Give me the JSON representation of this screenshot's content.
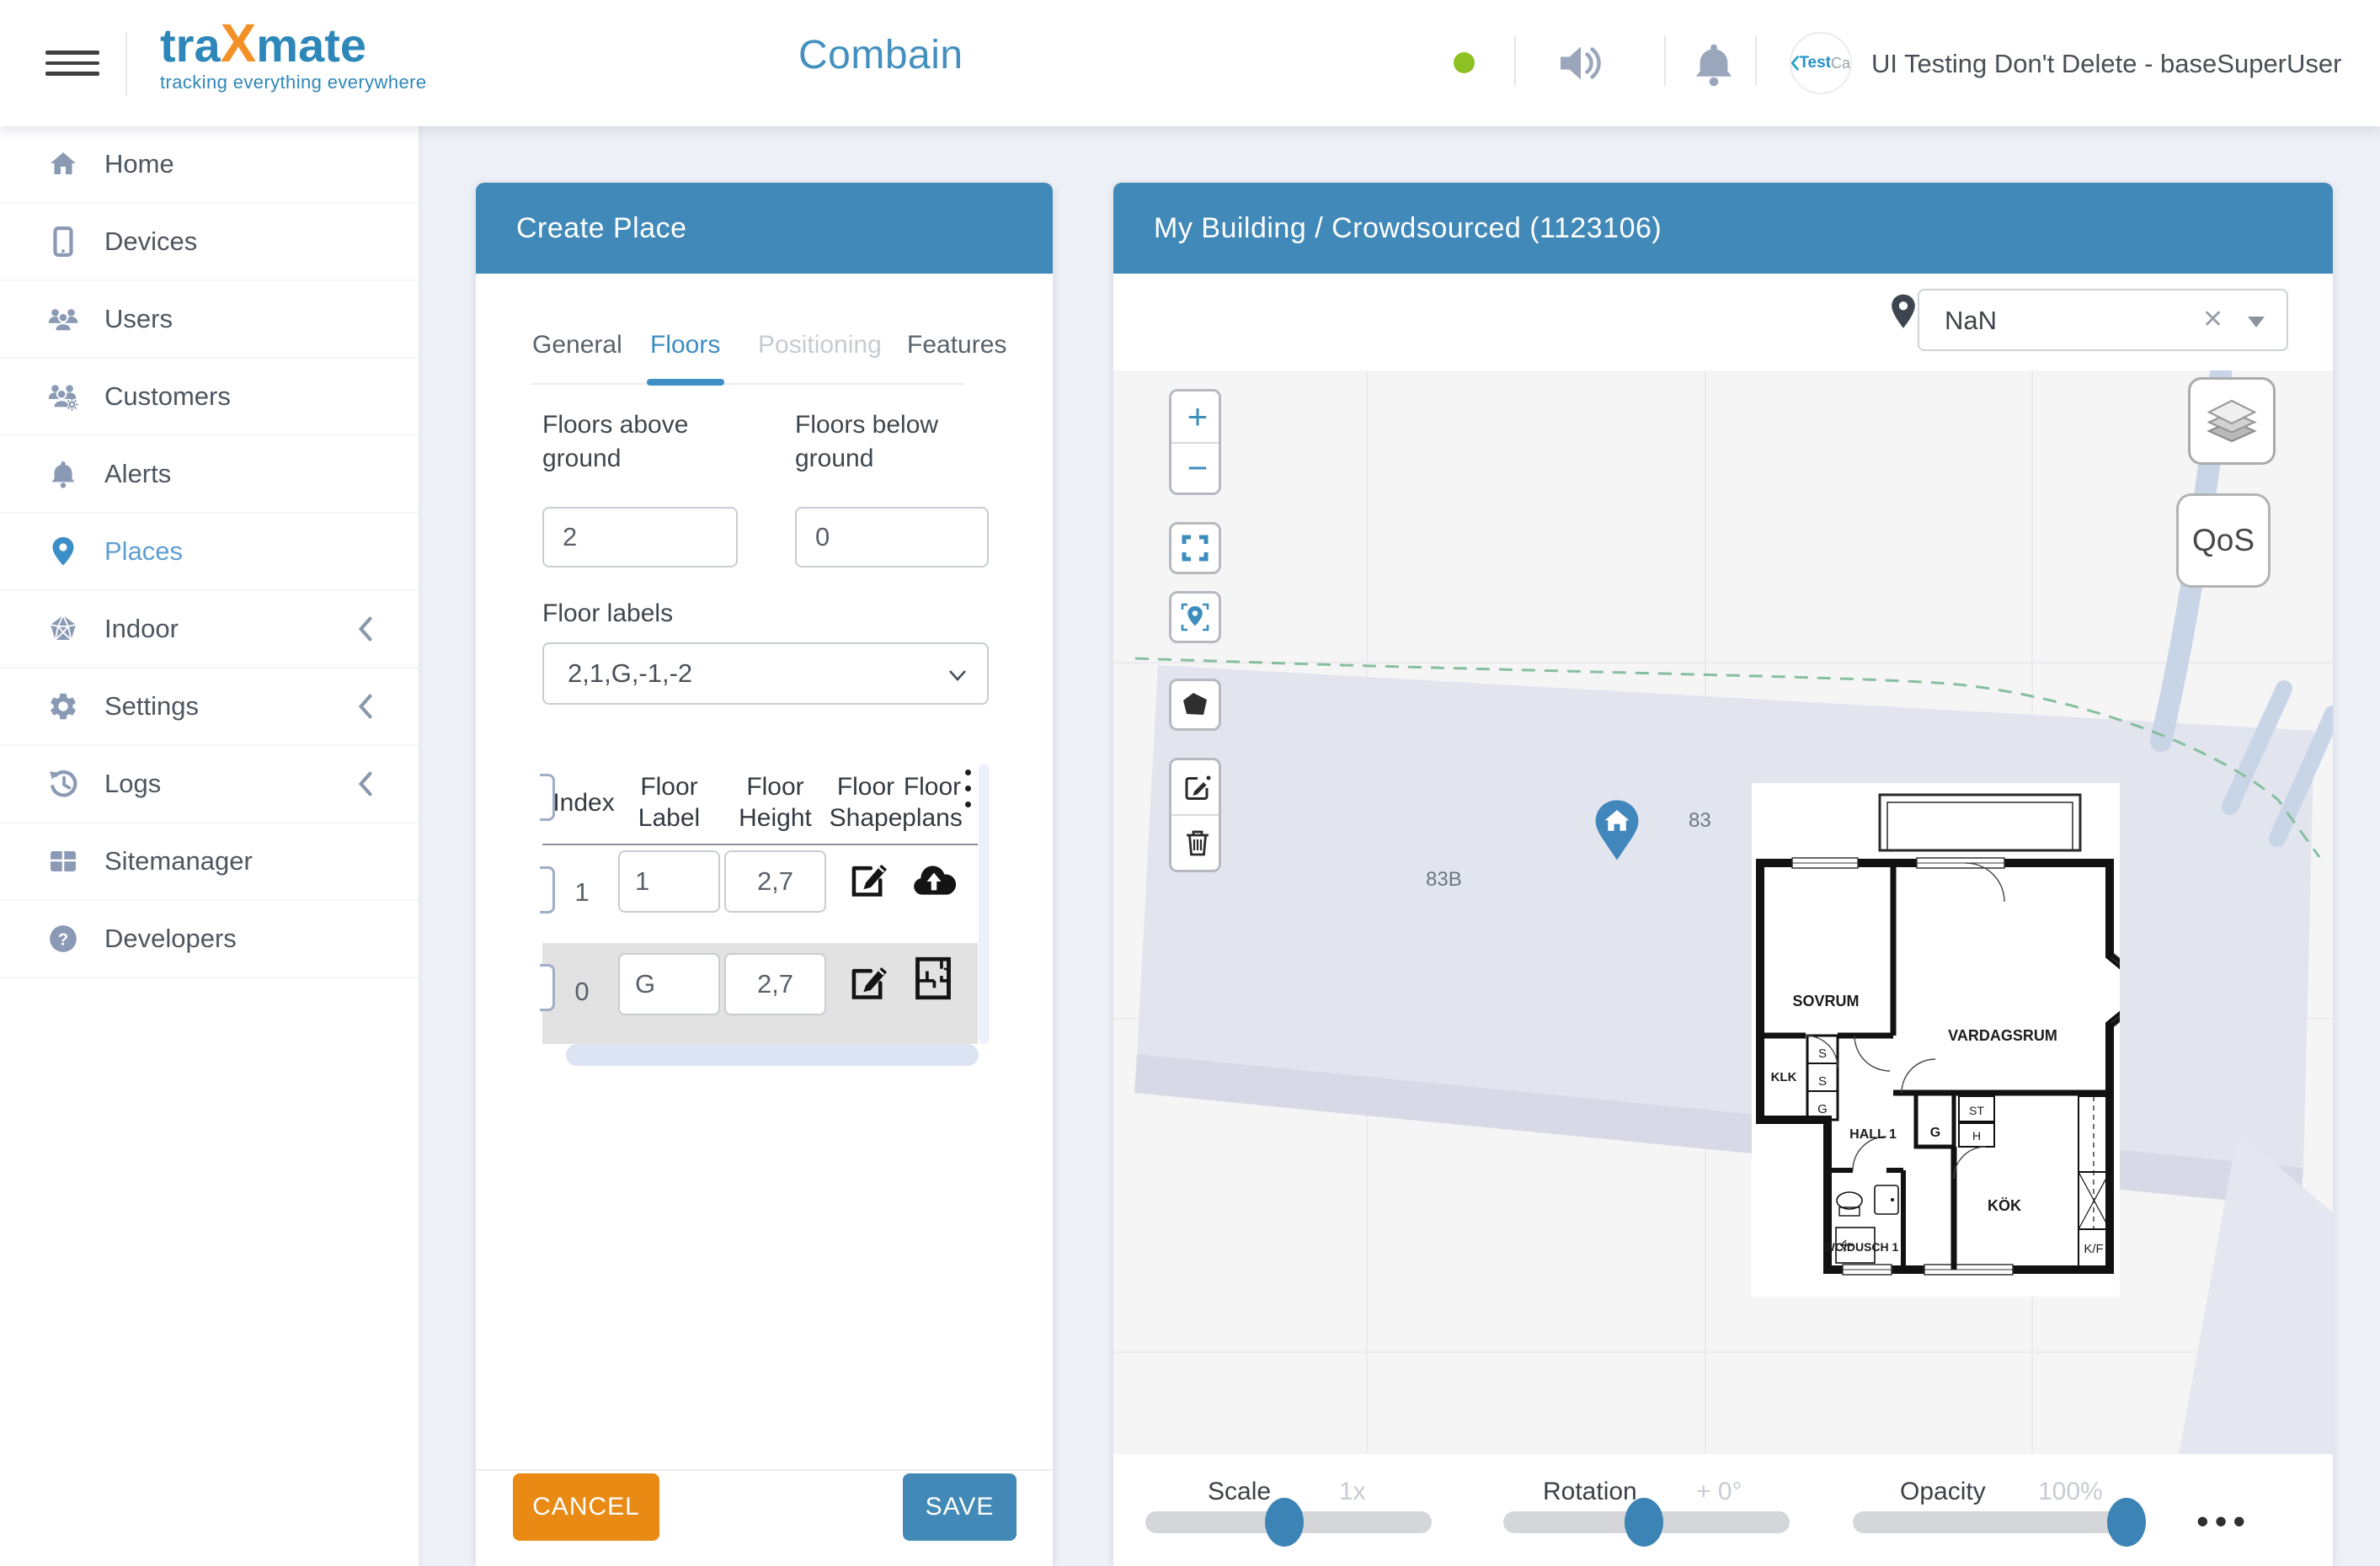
{
  "navbar": {
    "logo": {
      "part1": "tra",
      "part2": "X",
      "part3": "mate",
      "tagline": "tracking everything everywhere"
    },
    "title": "Combain",
    "user": {
      "avatar_text1": "Test",
      "avatar_text2": "Ca",
      "name": "UI Testing Don't Delete - baseSuperUser"
    }
  },
  "sidebar": {
    "items": [
      {
        "label": "Home"
      },
      {
        "label": "Devices"
      },
      {
        "label": "Users"
      },
      {
        "label": "Customers"
      },
      {
        "label": "Alerts"
      },
      {
        "label": "Places"
      },
      {
        "label": "Indoor"
      },
      {
        "label": "Settings"
      },
      {
        "label": "Logs"
      },
      {
        "label": "Sitemanager"
      },
      {
        "label": "Developers"
      }
    ]
  },
  "create_place": {
    "title": "Create Place",
    "tabs": [
      {
        "label": "General",
        "state": "default"
      },
      {
        "label": "Floors",
        "state": "active"
      },
      {
        "label": "Positioning",
        "state": "disabled"
      },
      {
        "label": "Features",
        "state": "default"
      }
    ],
    "form": {
      "floors_above": {
        "label": "Floors above ground",
        "value": "2"
      },
      "floors_below": {
        "label": "Floors below ground",
        "value": "0"
      },
      "floor_labels": {
        "label": "Floor labels",
        "value": "2,1,G,-1,-2"
      }
    },
    "table": {
      "columns": [
        "Index",
        "Floor Label",
        "Floor Height",
        "Floor Shape",
        "Floor plans"
      ],
      "rows": [
        {
          "index": "1",
          "floor_label": "1",
          "floor_height": "2,7"
        },
        {
          "index": "0",
          "floor_label": "G",
          "floor_height": "2,7"
        }
      ]
    },
    "actions": {
      "cancel": "CANCEL",
      "save": "SAVE"
    }
  },
  "map_panel": {
    "title": "My Building / Crowdsourced (1123106)",
    "floor_selector": {
      "value": "NaN",
      "clear": "✕"
    },
    "qos_label": "QoS",
    "address_labels": {
      "a": "83",
      "b": "83B"
    },
    "sliders": [
      {
        "label": "Scale",
        "value": "1x",
        "percent": 48.5
      },
      {
        "label": "Rotation",
        "value": "+ 0°",
        "percent": 49
      },
      {
        "label": "Opacity",
        "value": "100%",
        "percent": 95.6
      }
    ],
    "more": "•••"
  },
  "floorplan": {
    "rooms": {
      "sovrum": "SOVRUM",
      "vardagsrum": "VARDAGSRUM",
      "klk": "KLK",
      "s1": "S",
      "s2": "S",
      "g1": "G",
      "hall": "HALL 1",
      "g2": "G",
      "st": "ST",
      "h": "H",
      "kok": "KÖK",
      "wc": "WC/DUSCH 1",
      "kf": "K/F"
    }
  },
  "colors": {
    "accent_blue": "#4189b8",
    "cancel_orange": "#e98a15",
    "logo_orange": "#f39026",
    "logo_blue": "#2d87b9",
    "online_green": "#8cc023",
    "marker_blue": "#4187bb"
  }
}
